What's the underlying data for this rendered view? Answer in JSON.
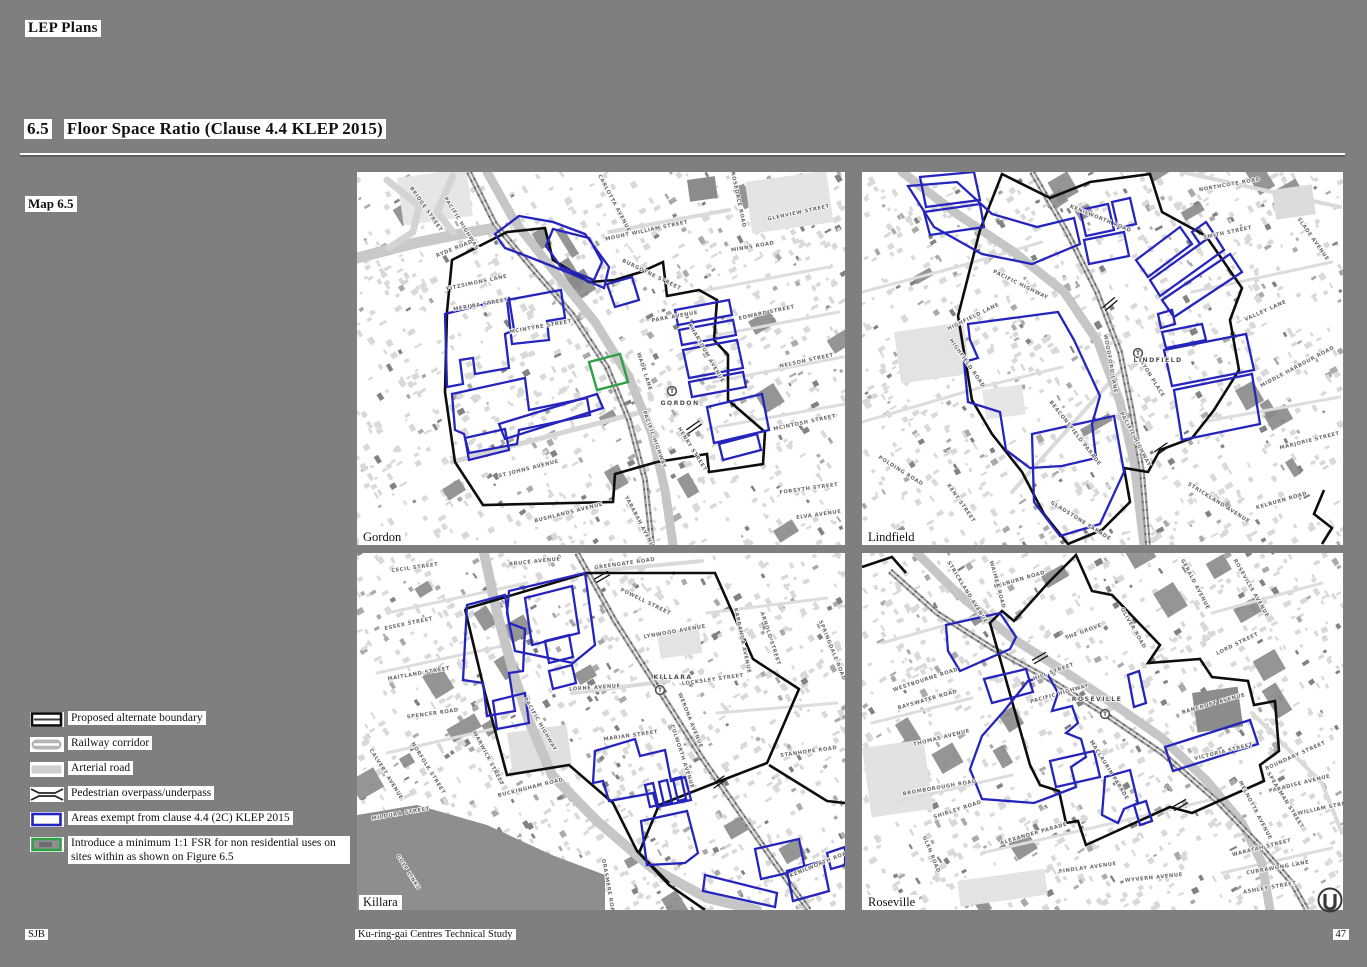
{
  "page": {
    "title": "LEP Plans",
    "section_number": "6.5",
    "section_title": "Floor Space Ratio (Clause 4.4 KLEP 2015)",
    "map_label": "Map 6.5"
  },
  "colors": {
    "page_bg": "#7f7f7f",
    "boundary_black": "#0d0d0d",
    "exempt_blue": "#2525bd",
    "fsr_green": "#2fa045",
    "railway_gray": "#9c9c9c",
    "arterial_gray": "#cfcfcf"
  },
  "legend": {
    "items": [
      {
        "icon": "boundary-swatch",
        "label": "Proposed alternate boundary"
      },
      {
        "icon": "railway-swatch",
        "label": "Railway corridor"
      },
      {
        "icon": "arterial-swatch",
        "label": "Arterial road"
      },
      {
        "icon": "overpass-swatch",
        "label": "Pedestrian overpass/underpass"
      },
      {
        "icon": "exempt-swatch",
        "label": "Areas exempt from clause 4.4 (2C) KLEP 2015"
      },
      {
        "icon": "fsr-swatch",
        "label": "Introduce a minimum 1:1 FSR for non residential uses on sites within as shown on Figure 6.5"
      }
    ]
  },
  "maps": [
    {
      "id": "gordon",
      "name": "Gordon",
      "station": {
        "label": "GORDON",
        "cx": 315,
        "cy": 219,
        "lx": 323,
        "ly": 233
      },
      "streets": [
        {
          "t": "BRIDGE STREET",
          "x": 68,
          "y": 38,
          "r": 55
        },
        {
          "t": "PACIFIC HIGHWAY",
          "x": 103,
          "y": 52,
          "r": 58
        },
        {
          "t": "RYDE ROAD",
          "x": 98,
          "y": 78,
          "r": -22
        },
        {
          "t": "FITZSIMONS LANE",
          "x": 120,
          "y": 112,
          "r": -12
        },
        {
          "t": "MERIWA STREET",
          "x": 124,
          "y": 134,
          "r": -10
        },
        {
          "t": "MCINTYRE STREET",
          "x": 184,
          "y": 156,
          "r": -10
        },
        {
          "t": "CARLOTTA AVENUE",
          "x": 256,
          "y": 32,
          "r": 62
        },
        {
          "t": "MOUNT WILLIAM STREET",
          "x": 290,
          "y": 60,
          "r": -12
        },
        {
          "t": "BURGOYNE STREET",
          "x": 294,
          "y": 104,
          "r": 26
        },
        {
          "t": "PARK AVENUE",
          "x": 318,
          "y": 146,
          "r": -10
        },
        {
          "t": "ROSEDALE ROAD",
          "x": 380,
          "y": 28,
          "r": 78
        },
        {
          "t": "GLENVIEW STREET",
          "x": 442,
          "y": 42,
          "r": -12
        },
        {
          "t": "MINNS ROAD",
          "x": 396,
          "y": 76,
          "r": -10
        },
        {
          "t": "EDWARD STREET",
          "x": 410,
          "y": 142,
          "r": -12
        },
        {
          "t": "NELSON STREET",
          "x": 450,
          "y": 190,
          "r": -12
        },
        {
          "t": "KHARTOUM AVENUE",
          "x": 348,
          "y": 182,
          "r": 60
        },
        {
          "t": "WADE LANE",
          "x": 286,
          "y": 200,
          "r": 72
        },
        {
          "t": "HENRY STREET",
          "x": 334,
          "y": 278,
          "r": 58
        },
        {
          "t": "PACIFIC HIGHWAY",
          "x": 296,
          "y": 268,
          "r": 70
        },
        {
          "t": "MCINTOSH STREET",
          "x": 448,
          "y": 252,
          "r": -12
        },
        {
          "t": "ST JOHNS AVENUE",
          "x": 172,
          "y": 298,
          "r": -14
        },
        {
          "t": "BUSHLANDS AVENUE",
          "x": 212,
          "y": 342,
          "r": -14
        },
        {
          "t": "YARABAH AVENUE",
          "x": 282,
          "y": 352,
          "r": 62
        },
        {
          "t": "FORSYTH STREET",
          "x": 452,
          "y": 318,
          "r": -8
        },
        {
          "t": "ELVA AVENUE",
          "x": 462,
          "y": 344,
          "r": -8
        }
      ]
    },
    {
      "id": "lindfield",
      "name": "Lindfield",
      "station": {
        "label": "LINDFIELD",
        "cx": 276,
        "cy": 181,
        "lx": 296,
        "ly": 190
      },
      "streets": [
        {
          "t": "NORTHCOTE ROAD",
          "x": 368,
          "y": 14,
          "r": -10
        },
        {
          "t": "SMITH STREET",
          "x": 366,
          "y": 62,
          "r": -12
        },
        {
          "t": "SLADE AVENUE",
          "x": 450,
          "y": 68,
          "r": 55
        },
        {
          "t": "KENILWORTH ROAD",
          "x": 238,
          "y": 48,
          "r": 22
        },
        {
          "t": "PACIFIC HIGHWAY",
          "x": 158,
          "y": 114,
          "r": 26
        },
        {
          "t": "HIGHFIELD LANE",
          "x": 112,
          "y": 146,
          "r": -26
        },
        {
          "t": "HIGHFIELD ROAD",
          "x": 104,
          "y": 192,
          "r": 55
        },
        {
          "t": "VALLEY LANE",
          "x": 404,
          "y": 140,
          "r": -24
        },
        {
          "t": "MIDDLE HARBOUR ROAD",
          "x": 436,
          "y": 196,
          "r": -28
        },
        {
          "t": "MARJORIE STREET",
          "x": 448,
          "y": 270,
          "r": -14
        },
        {
          "t": "TRYON PLACE",
          "x": 288,
          "y": 206,
          "r": 58
        },
        {
          "t": "WOODFORD LANE",
          "x": 247,
          "y": 192,
          "r": 80
        },
        {
          "t": "BEACONSFIELD PARADE",
          "x": 212,
          "y": 262,
          "r": 52
        },
        {
          "t": "PACIFIC HIGHWAY",
          "x": 272,
          "y": 268,
          "r": 62
        },
        {
          "t": "STRICKLAND AVENUE",
          "x": 356,
          "y": 332,
          "r": 32
        },
        {
          "t": "KELBURN ROAD",
          "x": 420,
          "y": 330,
          "r": -16
        },
        {
          "t": "GLADSTONE PARADE",
          "x": 218,
          "y": 350,
          "r": 32
        },
        {
          "t": "POLDING ROAD",
          "x": 38,
          "y": 300,
          "r": 32
        },
        {
          "t": "KENT STREET",
          "x": 98,
          "y": 332,
          "r": 55
        }
      ]
    },
    {
      "id": "killara",
      "name": "Killara",
      "station": {
        "label": "KILLARA",
        "cx": 303,
        "cy": 137,
        "lx": 316,
        "ly": 126
      },
      "streets": [
        {
          "t": "CECIL STREET",
          "x": 58,
          "y": 16,
          "r": -8
        },
        {
          "t": "BRUCE AVENUE",
          "x": 178,
          "y": 10,
          "r": -6
        },
        {
          "t": "GREENGATE ROAD",
          "x": 268,
          "y": 12,
          "r": -8
        },
        {
          "t": "POWELL STREET",
          "x": 288,
          "y": 50,
          "r": 26
        },
        {
          "t": "LYNWOOD AVENUE",
          "x": 318,
          "y": 80,
          "r": -10
        },
        {
          "t": "LOCKSLEY STREET",
          "x": 356,
          "y": 128,
          "r": -8
        },
        {
          "t": "KARRANGA AVENUE",
          "x": 384,
          "y": 88,
          "r": 78
        },
        {
          "t": "ARNOLD STREET",
          "x": 412,
          "y": 86,
          "r": 72
        },
        {
          "t": "SPRINGDALE ROAD",
          "x": 474,
          "y": 98,
          "r": 68
        },
        {
          "t": "ESSEX STREET",
          "x": 52,
          "y": 72,
          "r": -12
        },
        {
          "t": "MAITLAND STREET",
          "x": 62,
          "y": 122,
          "r": -10
        },
        {
          "t": "SPENCER ROAD",
          "x": 76,
          "y": 162,
          "r": -8
        },
        {
          "t": "LORNE AVENUE",
          "x": 238,
          "y": 136,
          "r": -4
        },
        {
          "t": "PACIFIC HIGHWAY",
          "x": 182,
          "y": 172,
          "r": 60
        },
        {
          "t": "MARIAN STREET",
          "x": 274,
          "y": 184,
          "r": -8
        },
        {
          "t": "WERONA AVENUE",
          "x": 332,
          "y": 168,
          "r": 68
        },
        {
          "t": "CULWORTH AVENUE",
          "x": 324,
          "y": 204,
          "r": 72
        },
        {
          "t": "BUCKINGHAM ROAD",
          "x": 174,
          "y": 236,
          "r": -14
        },
        {
          "t": "WARWICK STREET",
          "x": 130,
          "y": 206,
          "r": 62
        },
        {
          "t": "NORFOLK STREET",
          "x": 70,
          "y": 216,
          "r": 58
        },
        {
          "t": "MILDURA STREET",
          "x": 44,
          "y": 262,
          "r": -10
        },
        {
          "t": "CALVERT AVENUE",
          "x": 28,
          "y": 222,
          "r": 58
        },
        {
          "t": "STANHOPE ROAD",
          "x": 452,
          "y": 200,
          "r": -8
        },
        {
          "t": "KENILWORTH ROAD",
          "x": 464,
          "y": 312,
          "r": -22
        },
        {
          "t": "GOLF LINKS",
          "x": 50,
          "y": 320,
          "r": 58
        },
        {
          "t": "GRASMERE ROAD",
          "x": 250,
          "y": 335,
          "r": 80
        }
      ]
    },
    {
      "id": "roseville",
      "name": "Roseville",
      "station": {
        "label": "ROSEVILLE",
        "cx": 243,
        "cy": 161,
        "lx": 235,
        "ly": 148
      },
      "streets": [
        {
          "t": "KELBURN ROAD",
          "x": 158,
          "y": 28,
          "r": -16
        },
        {
          "t": "STRICKLAND AVENUE",
          "x": 104,
          "y": 40,
          "r": 58
        },
        {
          "t": "WAIMEA ROAD",
          "x": 134,
          "y": 32,
          "r": 75
        },
        {
          "t": "THE GROVE",
          "x": 222,
          "y": 80,
          "r": -20
        },
        {
          "t": "OLIVER ROAD",
          "x": 270,
          "y": 76,
          "r": 60
        },
        {
          "t": "GERALD AVENUE",
          "x": 332,
          "y": 32,
          "r": 62
        },
        {
          "t": "ROSEVILLE AVENUE",
          "x": 388,
          "y": 36,
          "r": 60
        },
        {
          "t": "LORD STREET",
          "x": 376,
          "y": 92,
          "r": -26
        },
        {
          "t": "HILL STREET",
          "x": 192,
          "y": 120,
          "r": -20
        },
        {
          "t": "PACIFIC HIGHWAY",
          "x": 198,
          "y": 142,
          "r": -16
        },
        {
          "t": "BANCROFT AVENUE",
          "x": 352,
          "y": 152,
          "r": -16
        },
        {
          "t": "VICTORIA STREET",
          "x": 362,
          "y": 200,
          "r": -14
        },
        {
          "t": "BOUNDARY STREET",
          "x": 434,
          "y": 204,
          "r": -24
        },
        {
          "t": "MACLAURIN PARADE",
          "x": 246,
          "y": 218,
          "r": 58
        },
        {
          "t": "WESTBOURNE ROAD",
          "x": 64,
          "y": 128,
          "r": -18
        },
        {
          "t": "BAYSWATER ROAD",
          "x": 66,
          "y": 148,
          "r": -16
        },
        {
          "t": "THOMAS AVENUE",
          "x": 80,
          "y": 186,
          "r": -14
        },
        {
          "t": "BROMBOROUGH ROAD",
          "x": 78,
          "y": 236,
          "r": -10
        },
        {
          "t": "SHIRLEY ROAD",
          "x": 96,
          "y": 258,
          "r": -18
        },
        {
          "t": "ALEXANDER PARADE",
          "x": 172,
          "y": 282,
          "r": -16
        },
        {
          "t": "FINDLAY AVENUE",
          "x": 226,
          "y": 316,
          "r": -8
        },
        {
          "t": "WYVERN AVENUE",
          "x": 292,
          "y": 326,
          "r": -6
        },
        {
          "t": "GLEN ROAD",
          "x": 68,
          "y": 302,
          "r": 68
        },
        {
          "t": "WARATAH STREET",
          "x": 400,
          "y": 296,
          "r": -14
        },
        {
          "t": "CURRAWONG LANE",
          "x": 416,
          "y": 316,
          "r": -10
        },
        {
          "t": "ASHLEY STREET",
          "x": 408,
          "y": 336,
          "r": -10
        },
        {
          "t": "MELNOTTE AVENUE",
          "x": 392,
          "y": 258,
          "r": 62
        },
        {
          "t": "PARADISE AVENUE",
          "x": 438,
          "y": 232,
          "r": -14
        },
        {
          "t": "WILLIAM STREET",
          "x": 464,
          "y": 256,
          "r": -12
        },
        {
          "t": "SPEARMAN STREET",
          "x": 422,
          "y": 248,
          "r": 58
        }
      ]
    }
  ],
  "footer": {
    "left": "SJB",
    "center": "Ku-ring-gai Centres Technical Study",
    "page_number": "47"
  }
}
